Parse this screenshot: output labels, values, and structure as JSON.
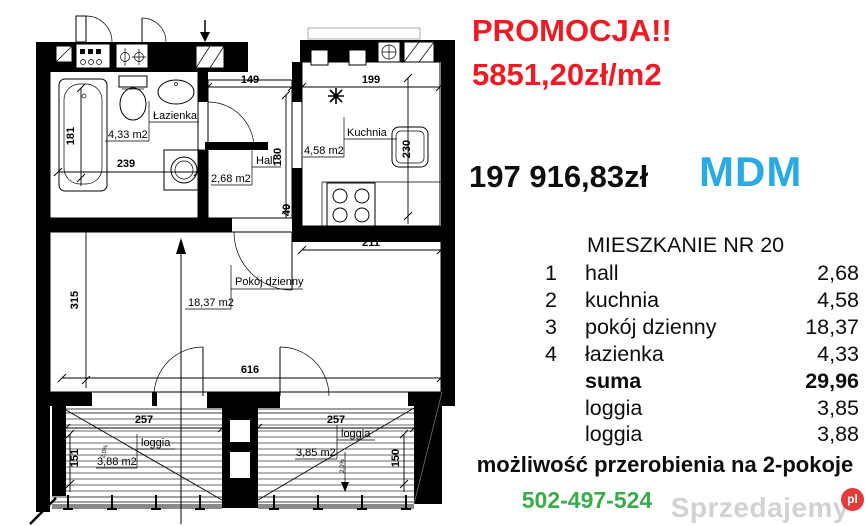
{
  "promo": {
    "line1": "PROMOCJA!!",
    "line2": "5851,20zł/m2",
    "price": "197 916,83zł",
    "program": "MDM"
  },
  "colors": {
    "promo_red": "#ed1c24",
    "mdm_blue": "#29abe2",
    "phone_green": "#3aab4a",
    "plan_ink": "#000000",
    "watermark_gray": "#d2d2d2",
    "watermark_badge_red": "#e23b3b"
  },
  "table": {
    "title": "MIESZKANIE NR 20",
    "rows": [
      {
        "num": "1",
        "name": "hall",
        "area": "2,68"
      },
      {
        "num": "2",
        "name": "kuchnia",
        "area": "4,58"
      },
      {
        "num": "3",
        "name": "pokój dzienny",
        "area": "18,37"
      },
      {
        "num": "4",
        "name": "łazienka",
        "area": "4,33"
      },
      {
        "num": "",
        "name": "suma",
        "area": "29,96"
      },
      {
        "num": "",
        "name": "loggia",
        "area": "3,85"
      },
      {
        "num": "",
        "name": "loggia",
        "area": "3,88"
      }
    ]
  },
  "footer": {
    "note": "możliwość przerobienia na 2-pokoje",
    "phone": "502-497-524"
  },
  "watermark": {
    "text": "Sprzedajemy",
    "badge": "pl"
  },
  "floorplan": {
    "rooms": {
      "bathroom": {
        "label": "Łazienka",
        "area": "4,33 m2"
      },
      "hall": {
        "label": "Hall",
        "area": "2,68 m2"
      },
      "kitchen": {
        "label": "Kuchnia",
        "area": "4,58 m2"
      },
      "living": {
        "label": "Pokój dzienny",
        "area": "18,37 m2"
      },
      "loggia_left": {
        "label": "loggia",
        "area": "3,88 m2"
      },
      "loggia_right": {
        "label": "loggia",
        "area": "3,85 m2"
      }
    },
    "dims": {
      "tub_length": "181",
      "bath_width": "239",
      "hall_width": "149",
      "kitchen_width": "199",
      "hall_depth": "180",
      "passage": "49",
      "kitchen_depth": "230",
      "kitchen_bottom": "211",
      "living_depth": "315",
      "living_width": "616",
      "loggia_left_width": "257",
      "loggia_right_width": "257",
      "loggia_left_depth": "151",
      "loggia_right_depth": "150",
      "slope_left": "2,0%",
      "slope_right": "2,0%"
    }
  }
}
